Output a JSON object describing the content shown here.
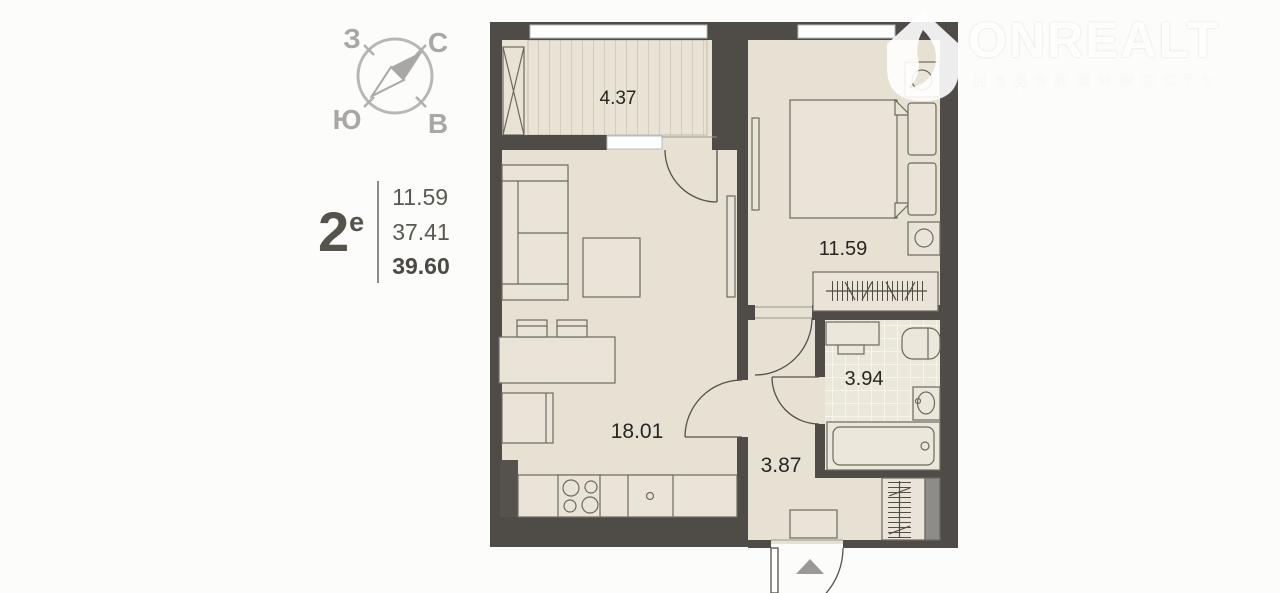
{
  "compass": {
    "west": "З",
    "north": "С",
    "south": "Ю",
    "east": "В"
  },
  "apartment": {
    "rooms_label": "2",
    "rooms_suffix": "е",
    "living_area": "11.59",
    "apartment_area": "37.41",
    "total_area": "39.60"
  },
  "watermark": {
    "brand": "ONREALT",
    "tagline": "НЕДВИЖИМОСТЬ"
  },
  "plan": {
    "balcony_area": "4.37",
    "bedroom_area": "11.59",
    "living_kitchen_area": "18.01",
    "bathroom_area": "3.94",
    "hallway_area": "3.87"
  },
  "colors": {
    "wall": "#4f4b47",
    "floor": "#e7e1d3",
    "floor_light": "#e9e3d6",
    "outline": "#6e695f",
    "compass_gray": "#a9a7a3",
    "label_text": "#262622",
    "sidebar_text": "#56544d",
    "shaft_gray": "#8e8c89",
    "entry_arrow": "#9b9995",
    "window_white": "#fdfefe"
  }
}
